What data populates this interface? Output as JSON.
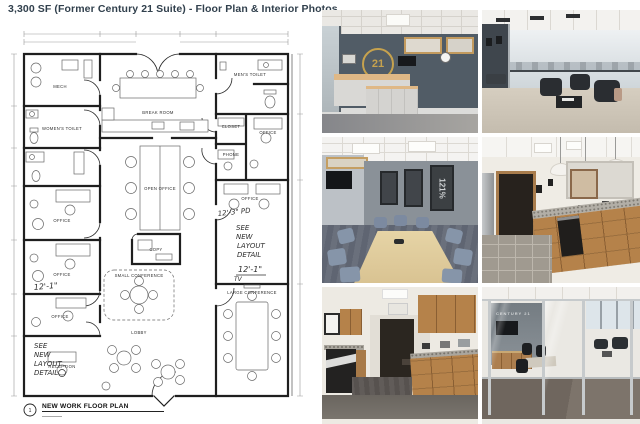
{
  "page": {
    "title": "3,300 SF (Former Century 21 Suite) - Floor Plan & Interior Photos"
  },
  "colors": {
    "title_text": "#31404d",
    "brand_gold": "#c6a24e",
    "reception_wall": "#515c66",
    "cabinet_wood": "#b5824a"
  },
  "floor_plan": {
    "title": "NEW WORK FLOOR PLAN",
    "detail_number": "1",
    "rooms": {
      "mech": "MECH",
      "womens_toilet": "WOMEN'S TOILET",
      "mens_toilet": "MEN'S TOILET",
      "office": "OFFICE",
      "break_room": "BREAK ROOM",
      "open_office": "OPEN OFFICE",
      "copy": "COPY",
      "closet": "CLOSET",
      "phone": "PHONE",
      "small_conference": "SMALL CONFERENCE",
      "large_conference": "LARGE CONFERENCE",
      "lobby": "LOBBY",
      "reception": "RECEPTION"
    },
    "annotations": {
      "dim_12_1": "12'-1\"",
      "dim_12_3_pd": "12'-3\" PD",
      "note_l1": "SEE",
      "note_l2": "NEW",
      "note_l3": "LAYOUT",
      "note_l4": "DETAIL",
      "tv": "TV"
    }
  },
  "photos": {
    "reception": {
      "logo_text": "21"
    },
    "conference": {
      "poster_text": "121%"
    },
    "glass_conference": {
      "wall_text": "CENTURY 21"
    }
  }
}
